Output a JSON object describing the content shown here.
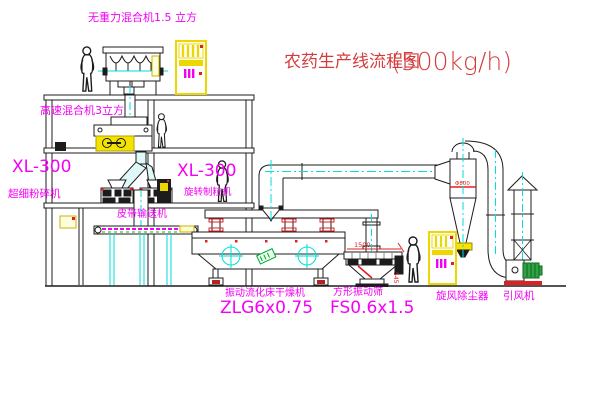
{
  "title": {
    "name": "农药生产线流程图",
    "capacity": "(500kg/h)"
  },
  "labels": {
    "gravity_mixer": "无重力混合机1.5 立方",
    "high_speed_mixer": "高速混合机3立方",
    "xl_left_model": "XL-300",
    "xl_left_name": "超细粉碎机",
    "xl_mid_model": "XL-300",
    "xl_mid_name": "旋转制粒机",
    "belt": "皮带输送机",
    "dryer_name": "振动流化床干燥机",
    "dryer_model": "ZLG6x0.75",
    "screen_name": "方形振动筛",
    "screen_model": "FS0.6x1.5",
    "cyclone_name": "旋风除尘器",
    "fan_name": "引风机"
  },
  "dimensions": {
    "screen_width": "1500",
    "screen_height": "545",
    "cyclone_dia": "Φ800"
  },
  "colors": {
    "line": "#1c1c1c",
    "centerline_cyan": "#00dede",
    "label_magenta": "#f400f4",
    "title_red": "#d43c3c",
    "accent_red": "#e02020",
    "equipment_yellow": "#ecd800",
    "motor_green": "#2fa344"
  }
}
